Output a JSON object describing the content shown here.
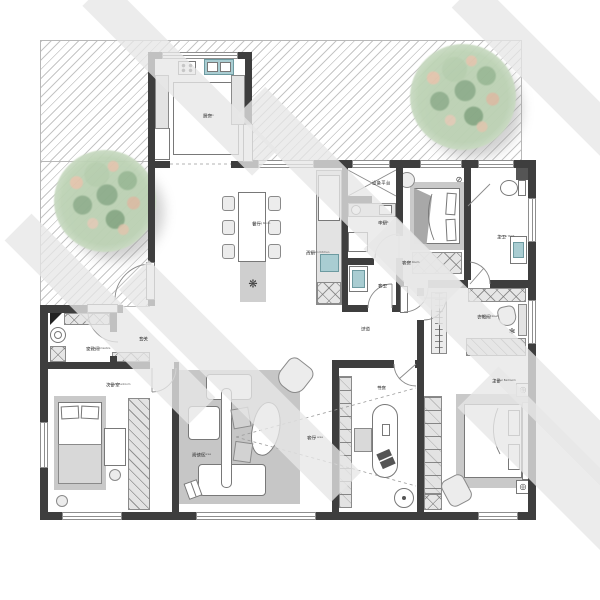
{
  "rooms": {
    "kitchen": {
      "zh": "厨房",
      "en": "Kitchen"
    },
    "dining": {
      "zh": "餐厅",
      "en": "Dining Room"
    },
    "west_kitchen": {
      "zh": "西厨",
      "en": "Western Kitchen"
    },
    "equipment": {
      "zh": "设备平台",
      "en": ""
    },
    "wet_kitchen": {
      "zh": "中厨",
      "en": "Wet Kit."
    },
    "toilet": {
      "zh": "客卫",
      "en": "Toilet"
    },
    "guest_room": {
      "zh": "客房",
      "en": "Guest Room"
    },
    "master_bath": {
      "zh": "主卫",
      "en": "Master Bath"
    },
    "closet": {
      "zh": "衣帽间",
      "en": "Walking Closet"
    },
    "master_bedroom": {
      "zh": "主卧",
      "en": "Master Bedroom"
    },
    "foyer": {
      "zh": "玄关",
      "en": "Foyer"
    },
    "home_domestics": {
      "zh": "家政间",
      "en": "Home Domestics"
    },
    "second_bedroom": {
      "zh": "次卧室",
      "en": "Second Bedroom"
    },
    "reading_area": {
      "zh": "阅读区",
      "en": "Reading area"
    },
    "living_area": {
      "zh": "客厅",
      "en": "Living area"
    },
    "study": {
      "zh": "书房",
      "en": "Study"
    },
    "hall": {
      "zh": "过道",
      "en": "Hall"
    }
  },
  "icons": {
    "plant": "❋",
    "socket": "◎",
    "fan": "⊘",
    "flower": "✻"
  },
  "colors": {
    "wall": "#3e3e3e",
    "cabinet_fill": "#e3e3e3",
    "rug": "#c6c6c6",
    "bed_frame": "#c9c9c9",
    "sink_teal": "#a9cdd2",
    "tree_green": "#a9c4a1",
    "tree_peach": "#e4c4ac",
    "hatch_line": "#b3b3b3",
    "watermark": "#e7e7e7"
  }
}
